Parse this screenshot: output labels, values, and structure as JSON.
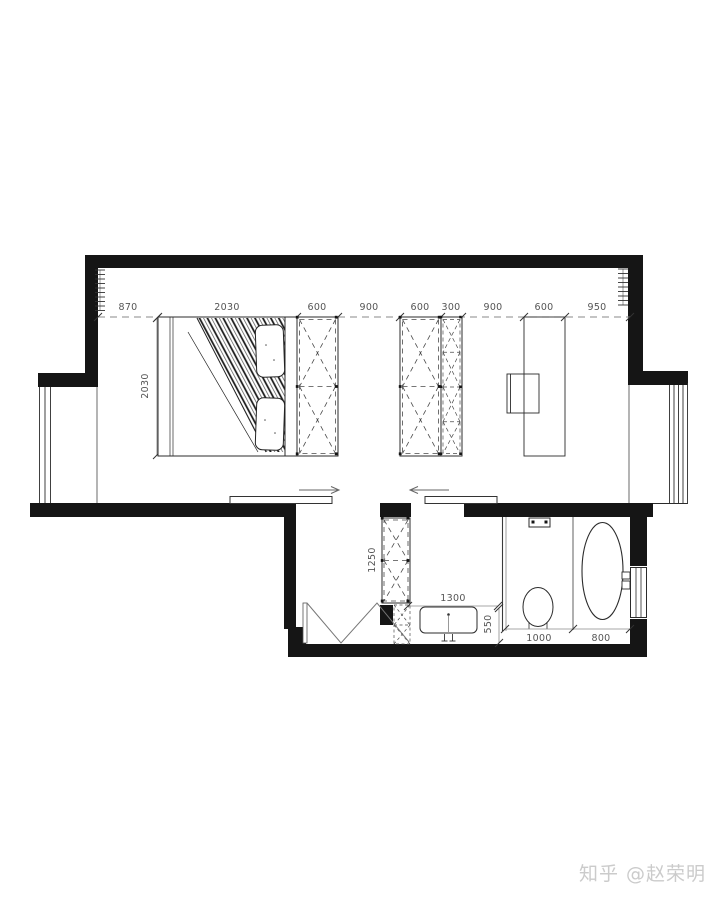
{
  "plan": {
    "dims_top": [
      "870",
      "2030",
      "600",
      "900",
      "600",
      "300",
      "900",
      "600",
      "950"
    ],
    "dim_bed_depth": "2030",
    "dim_hall_cabinet": "1250",
    "dim_vanity_width": "1300",
    "dim_vanity_depth": "550",
    "dim_toilet_zone": "1000",
    "dim_bathtub_zone": "800"
  },
  "colors": {
    "wall": "#151515",
    "furniture_line": "#2b2b2b",
    "cabinet_dash": "#4a4a4a",
    "dim_line": "#8a8a8a",
    "dim_text": "#555555",
    "watermark": "#cbcbcb"
  },
  "watermark": "知乎 @赵荣明"
}
